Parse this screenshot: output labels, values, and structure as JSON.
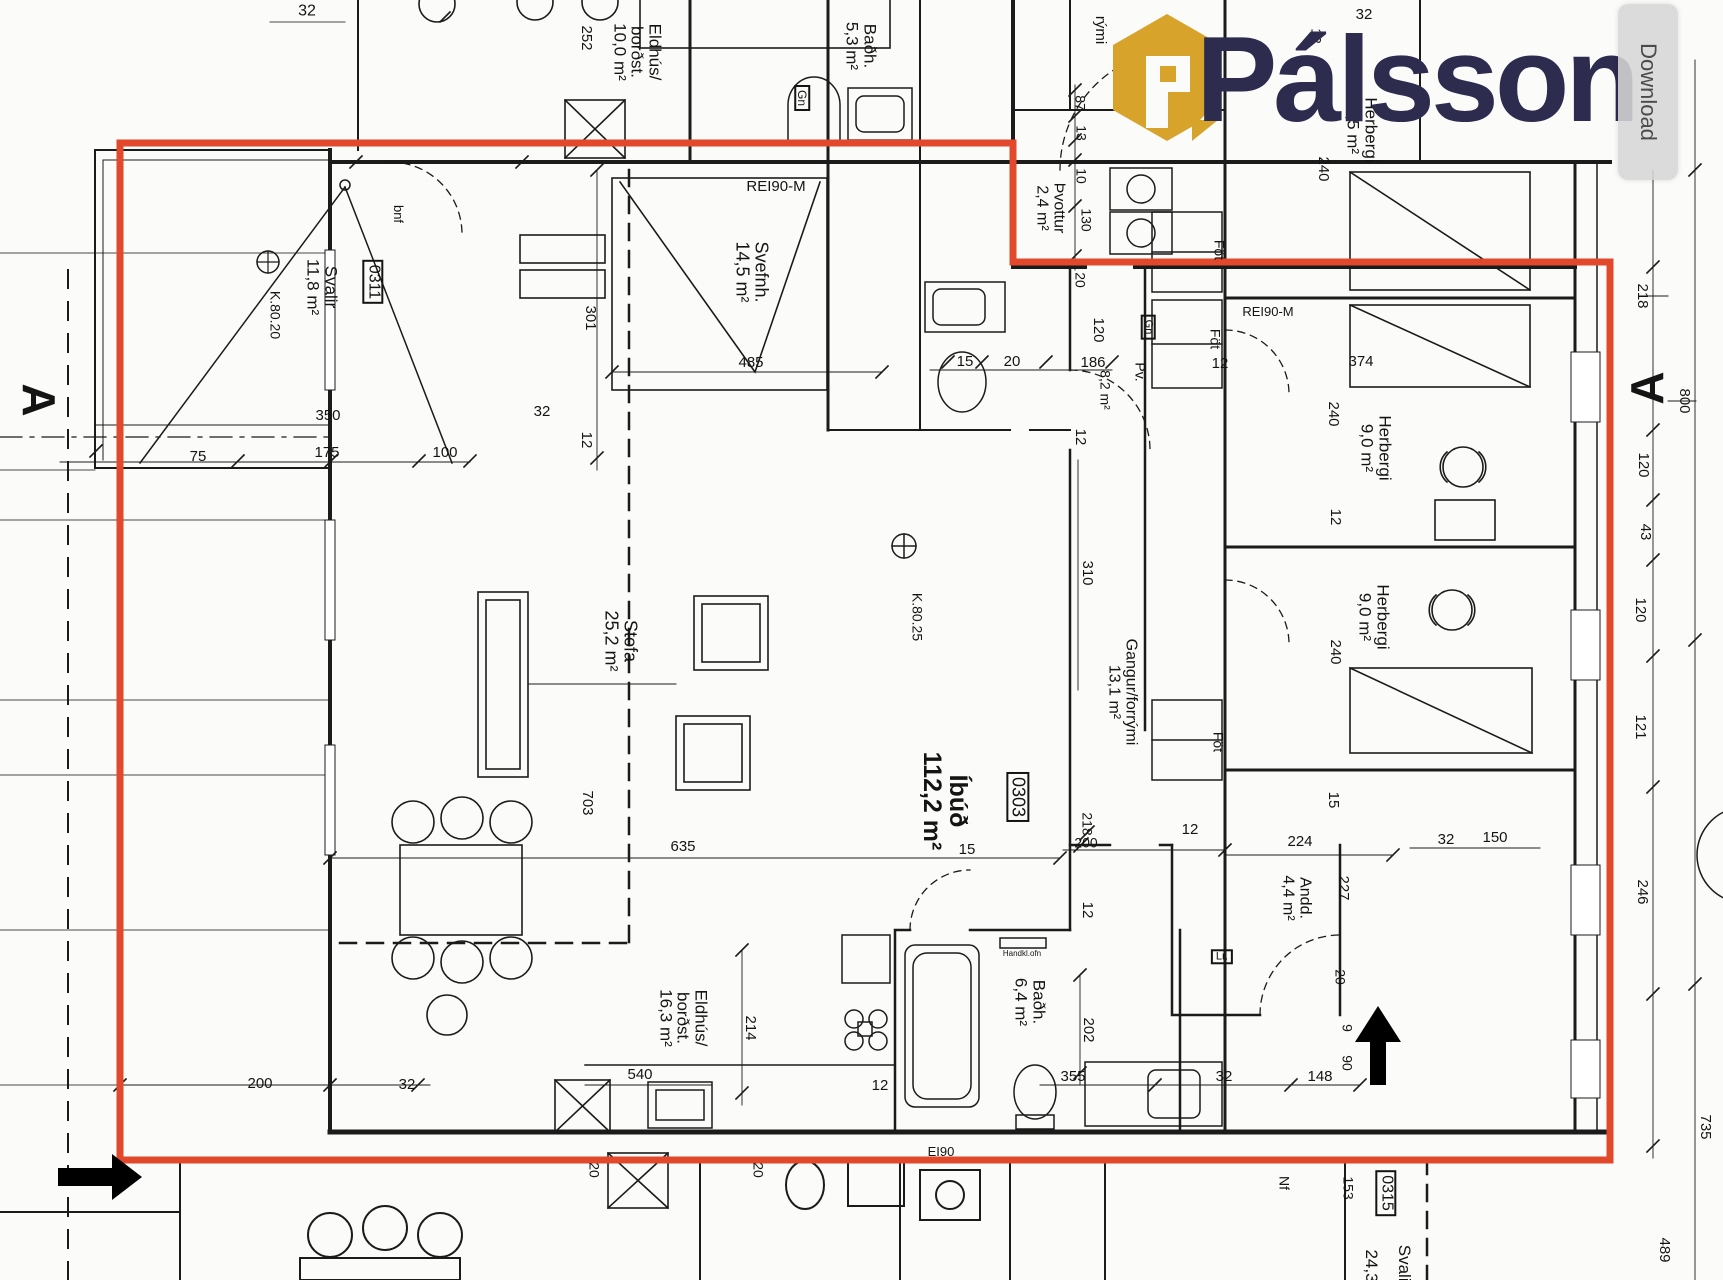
{
  "colors": {
    "red": "#E2482B",
    "gold": "#D7A32A",
    "navy": "#2D2B4E",
    "ink": "#1B1B1B"
  },
  "watermark": {
    "brand": "Pálsson"
  },
  "viewer": {
    "download_label": "Download"
  },
  "plan": {
    "unit_highlighted": "0303",
    "labels": [
      {
        "text": "32",
        "x": 307,
        "y": 12,
        "rot": 0,
        "size": 16
      },
      {
        "text": "252",
        "x": 586,
        "y": 38,
        "rot": 90,
        "size": 15
      },
      {
        "text": "Eldhús/\nborðst.\n10,0 m²",
        "x": 637,
        "y": 52,
        "rot": 90,
        "size": 17
      },
      {
        "text": "Baðh.\n5,3 m²",
        "x": 861,
        "y": 46,
        "rot": 90,
        "size": 17
      },
      {
        "text": "Gn",
        "x": 802,
        "y": 98,
        "rot": 90,
        "size": 12,
        "boxed": true
      },
      {
        "text": "rými",
        "x": 1100,
        "y": 30,
        "rot": 90,
        "size": 15
      },
      {
        "text": "REI90-M",
        "x": 776,
        "y": 187,
        "rot": 0,
        "size": 15
      },
      {
        "text": "Svefnh.\n14,5 m²",
        "x": 752,
        "y": 272,
        "rot": 90,
        "size": 18
      },
      {
        "text": "301",
        "x": 590,
        "y": 318,
        "rot": 90,
        "size": 15
      },
      {
        "text": "485",
        "x": 751,
        "y": 363,
        "rot": 0,
        "size": 15
      },
      {
        "text": "32",
        "x": 542,
        "y": 412,
        "rot": 0,
        "size": 15
      },
      {
        "text": "12",
        "x": 586,
        "y": 440,
        "rot": 90,
        "size": 15
      },
      {
        "text": "bnf",
        "x": 398,
        "y": 214,
        "rot": 90,
        "size": 13
      },
      {
        "text": "0311",
        "x": 373,
        "y": 282,
        "rot": 90,
        "size": 16,
        "boxed": true
      },
      {
        "text": "Svalir\n11,8 m²",
        "x": 322,
        "y": 287,
        "rot": 90,
        "size": 17
      },
      {
        "text": "K.80.20",
        "x": 275,
        "y": 315,
        "rot": 90,
        "size": 14
      },
      {
        "text": "350",
        "x": 328,
        "y": 416,
        "rot": 0,
        "size": 15
      },
      {
        "text": "75",
        "x": 198,
        "y": 457,
        "rot": 0,
        "size": 15
      },
      {
        "text": "175",
        "x": 327,
        "y": 453,
        "rot": 0,
        "size": 15
      },
      {
        "text": "100",
        "x": 445,
        "y": 453,
        "rot": 0,
        "size": 15
      },
      {
        "text": "87",
        "x": 1080,
        "y": 103,
        "rot": 90,
        "size": 14
      },
      {
        "text": "13",
        "x": 1081,
        "y": 133,
        "rot": 90,
        "size": 14
      },
      {
        "text": "10",
        "x": 1081,
        "y": 176,
        "rot": 90,
        "size": 14
      },
      {
        "text": "130",
        "x": 1086,
        "y": 220,
        "rot": 90,
        "size": 14
      },
      {
        "text": "20",
        "x": 1080,
        "y": 280,
        "rot": 90,
        "size": 14
      },
      {
        "text": "Þvottur\n2,4 m²",
        "x": 1050,
        "y": 208,
        "rot": 90,
        "size": 16
      },
      {
        "text": "15",
        "x": 965,
        "y": 362,
        "rot": 0,
        "size": 15
      },
      {
        "text": "20",
        "x": 1012,
        "y": 362,
        "rot": 0,
        "size": 15
      },
      {
        "text": "186",
        "x": 1093,
        "y": 363,
        "rot": 0,
        "size": 15
      },
      {
        "text": "120",
        "x": 1098,
        "y": 330,
        "rot": 90,
        "size": 15
      },
      {
        "text": "8,2 m²",
        "x": 1105,
        "y": 390,
        "rot": 90,
        "size": 14
      },
      {
        "text": "Pv.",
        "x": 1140,
        "y": 372,
        "rot": 90,
        "size": 14
      },
      {
        "text": "Gn",
        "x": 1148,
        "y": 327,
        "rot": 90,
        "size": 11,
        "boxed": true
      },
      {
        "text": "12",
        "x": 1220,
        "y": 364,
        "rot": 0,
        "size": 15
      },
      {
        "text": "Föt",
        "x": 1219,
        "y": 250,
        "rot": 90,
        "size": 14
      },
      {
        "text": "Föt",
        "x": 1215,
        "y": 339,
        "rot": 90,
        "size": 14
      },
      {
        "text": "REI90-M",
        "x": 1268,
        "y": 312,
        "rot": 0,
        "size": 13
      },
      {
        "text": "12",
        "x": 1080,
        "y": 437,
        "rot": 90,
        "size": 15
      },
      {
        "text": "310",
        "x": 1087,
        "y": 573,
        "rot": 90,
        "size": 15
      },
      {
        "text": "Gangur/forrými\n13,1 m²",
        "x": 1122,
        "y": 692,
        "rot": 90,
        "size": 16
      },
      {
        "text": "Föt",
        "x": 1218,
        "y": 742,
        "rot": 90,
        "size": 14
      },
      {
        "text": "K.80.25",
        "x": 917,
        "y": 617,
        "rot": 90,
        "size": 14
      },
      {
        "text": "Stofa\n25,2 m²",
        "x": 621,
        "y": 641,
        "rot": 90,
        "size": 18
      },
      {
        "text": "703",
        "x": 587,
        "y": 803,
        "rot": 90,
        "size": 15
      },
      {
        "text": "635",
        "x": 683,
        "y": 847,
        "rot": 0,
        "size": 15
      },
      {
        "text": "Íbúð\n112,2 m²",
        "x": 945,
        "y": 801,
        "rot": 90,
        "size": 25,
        "bold": true
      },
      {
        "text": "0303",
        "x": 1018,
        "y": 797,
        "rot": 90,
        "size": 18,
        "boxed": true
      },
      {
        "text": "15",
        "x": 967,
        "y": 850,
        "rot": 0,
        "size": 15
      },
      {
        "text": "218",
        "x": 1087,
        "y": 824,
        "rot": 90,
        "size": 14
      },
      {
        "text": "200",
        "x": 1086,
        "y": 843,
        "rot": 0,
        "size": 14
      },
      {
        "text": "12",
        "x": 1190,
        "y": 830,
        "rot": 0,
        "size": 15
      },
      {
        "text": "224",
        "x": 1300,
        "y": 842,
        "rot": 0,
        "size": 15
      },
      {
        "text": "15",
        "x": 1333,
        "y": 800,
        "rot": 90,
        "size": 15
      },
      {
        "text": "32",
        "x": 1446,
        "y": 840,
        "rot": 0,
        "size": 15
      },
      {
        "text": "150",
        "x": 1495,
        "y": 838,
        "rot": 0,
        "size": 15
      },
      {
        "text": "227",
        "x": 1343,
        "y": 888,
        "rot": 90,
        "size": 15
      },
      {
        "text": "Andd.\n4,4 m²",
        "x": 1296,
        "y": 898,
        "rot": 90,
        "size": 16
      },
      {
        "text": "12",
        "x": 1087,
        "y": 910,
        "rot": 90,
        "size": 15
      },
      {
        "text": "Baðh.\n6,4 m²",
        "x": 1030,
        "y": 1002,
        "rot": 90,
        "size": 17
      },
      {
        "text": "Handkl.ofn",
        "x": 1022,
        "y": 954,
        "rot": 0,
        "size": 8
      },
      {
        "text": "202",
        "x": 1088,
        "y": 1030,
        "rot": 90,
        "size": 15
      },
      {
        "text": "355",
        "x": 1073,
        "y": 1077,
        "rot": 0,
        "size": 15
      },
      {
        "text": "32",
        "x": 1224,
        "y": 1077,
        "rot": 0,
        "size": 15
      },
      {
        "text": "148",
        "x": 1320,
        "y": 1077,
        "rot": 0,
        "size": 15
      },
      {
        "text": "20",
        "x": 1340,
        "y": 977,
        "rot": 90,
        "size": 14
      },
      {
        "text": "9",
        "x": 1347,
        "y": 1028,
        "rot": 90,
        "size": 14
      },
      {
        "text": "90",
        "x": 1347,
        "y": 1063,
        "rot": 90,
        "size": 14
      },
      {
        "text": "Lr.",
        "x": 1222,
        "y": 957,
        "rot": 0,
        "size": 11,
        "boxed": true
      },
      {
        "text": "Eldhús/\nborðst.\n16,3 m²",
        "x": 683,
        "y": 1018,
        "rot": 90,
        "size": 17
      },
      {
        "text": "214",
        "x": 750,
        "y": 1028,
        "rot": 90,
        "size": 15
      },
      {
        "text": "540",
        "x": 640,
        "y": 1075,
        "rot": 0,
        "size": 15
      },
      {
        "text": "12",
        "x": 880,
        "y": 1086,
        "rot": 0,
        "size": 15
      },
      {
        "text": "200",
        "x": 260,
        "y": 1084,
        "rot": 0,
        "size": 15
      },
      {
        "text": "32",
        "x": 407,
        "y": 1085,
        "rot": 0,
        "size": 15
      },
      {
        "text": "20",
        "x": 594,
        "y": 1170,
        "rot": 90,
        "size": 14
      },
      {
        "text": "20",
        "x": 758,
        "y": 1170,
        "rot": 90,
        "size": 14
      },
      {
        "text": "EI90",
        "x": 941,
        "y": 1152,
        "rot": 0,
        "size": 13
      },
      {
        "text": "Nf",
        "x": 1284,
        "y": 1183,
        "rot": 90,
        "size": 14
      },
      {
        "text": "153",
        "x": 1348,
        "y": 1188,
        "rot": 90,
        "size": 14
      },
      {
        "text": "0315",
        "x": 1386,
        "y": 1193,
        "rot": 90,
        "size": 16,
        "boxed": true
      },
      {
        "text": "Svalir",
        "x": 1404,
        "y": 1266,
        "rot": 90,
        "size": 17
      },
      {
        "text": "24,3",
        "x": 1371,
        "y": 1266,
        "rot": 90,
        "size": 17
      },
      {
        "text": "218",
        "x": 1642,
        "y": 296,
        "rot": 90,
        "size": 15
      },
      {
        "text": "120",
        "x": 1643,
        "y": 465,
        "rot": 90,
        "size": 15
      },
      {
        "text": "43",
        "x": 1645,
        "y": 532,
        "rot": 90,
        "size": 15
      },
      {
        "text": "120",
        "x": 1640,
        "y": 610,
        "rot": 90,
        "size": 15
      },
      {
        "text": "121",
        "x": 1640,
        "y": 727,
        "rot": 90,
        "size": 15
      },
      {
        "text": "246",
        "x": 1642,
        "y": 892,
        "rot": 90,
        "size": 15
      },
      {
        "text": "800",
        "x": 1684,
        "y": 401,
        "rot": 90,
        "size": 15
      },
      {
        "text": "735",
        "x": 1705,
        "y": 1127,
        "rot": 90,
        "size": 15
      },
      {
        "text": "489",
        "x": 1664,
        "y": 1250,
        "rot": 90,
        "size": 15
      },
      {
        "text": "374",
        "x": 1361,
        "y": 362,
        "rot": 0,
        "size": 15
      },
      {
        "text": "240",
        "x": 1333,
        "y": 414,
        "rot": 90,
        "size": 15
      },
      {
        "text": "Herbergi\n9,0 m²",
        "x": 1376,
        "y": 448,
        "rot": 90,
        "size": 17
      },
      {
        "text": "12",
        "x": 1335,
        "y": 517,
        "rot": 90,
        "size": 15
      },
      {
        "text": "Herbergi\n9,0 m²",
        "x": 1374,
        "y": 617,
        "rot": 90,
        "size": 17
      },
      {
        "text": "240",
        "x": 1335,
        "y": 652,
        "rot": 90,
        "size": 15
      },
      {
        "text": "32",
        "x": 1364,
        "y": 15,
        "rot": 0,
        "size": 15
      },
      {
        "text": "12",
        "x": 1316,
        "y": 36,
        "rot": 90,
        "size": 14
      },
      {
        "text": "240",
        "x": 1323,
        "y": 169,
        "rot": 90,
        "size": 15
      },
      {
        "text": "Herbergi\n9,5 m²",
        "x": 1362,
        "y": 130,
        "rot": 90,
        "size": 17
      },
      {
        "text": "A",
        "x": 38,
        "y": 400,
        "rot": 90,
        "size": 46,
        "bold": true
      },
      {
        "text": "A",
        "x": 1648,
        "y": 388,
        "rot": -90,
        "size": 46,
        "bold": true
      }
    ]
  }
}
